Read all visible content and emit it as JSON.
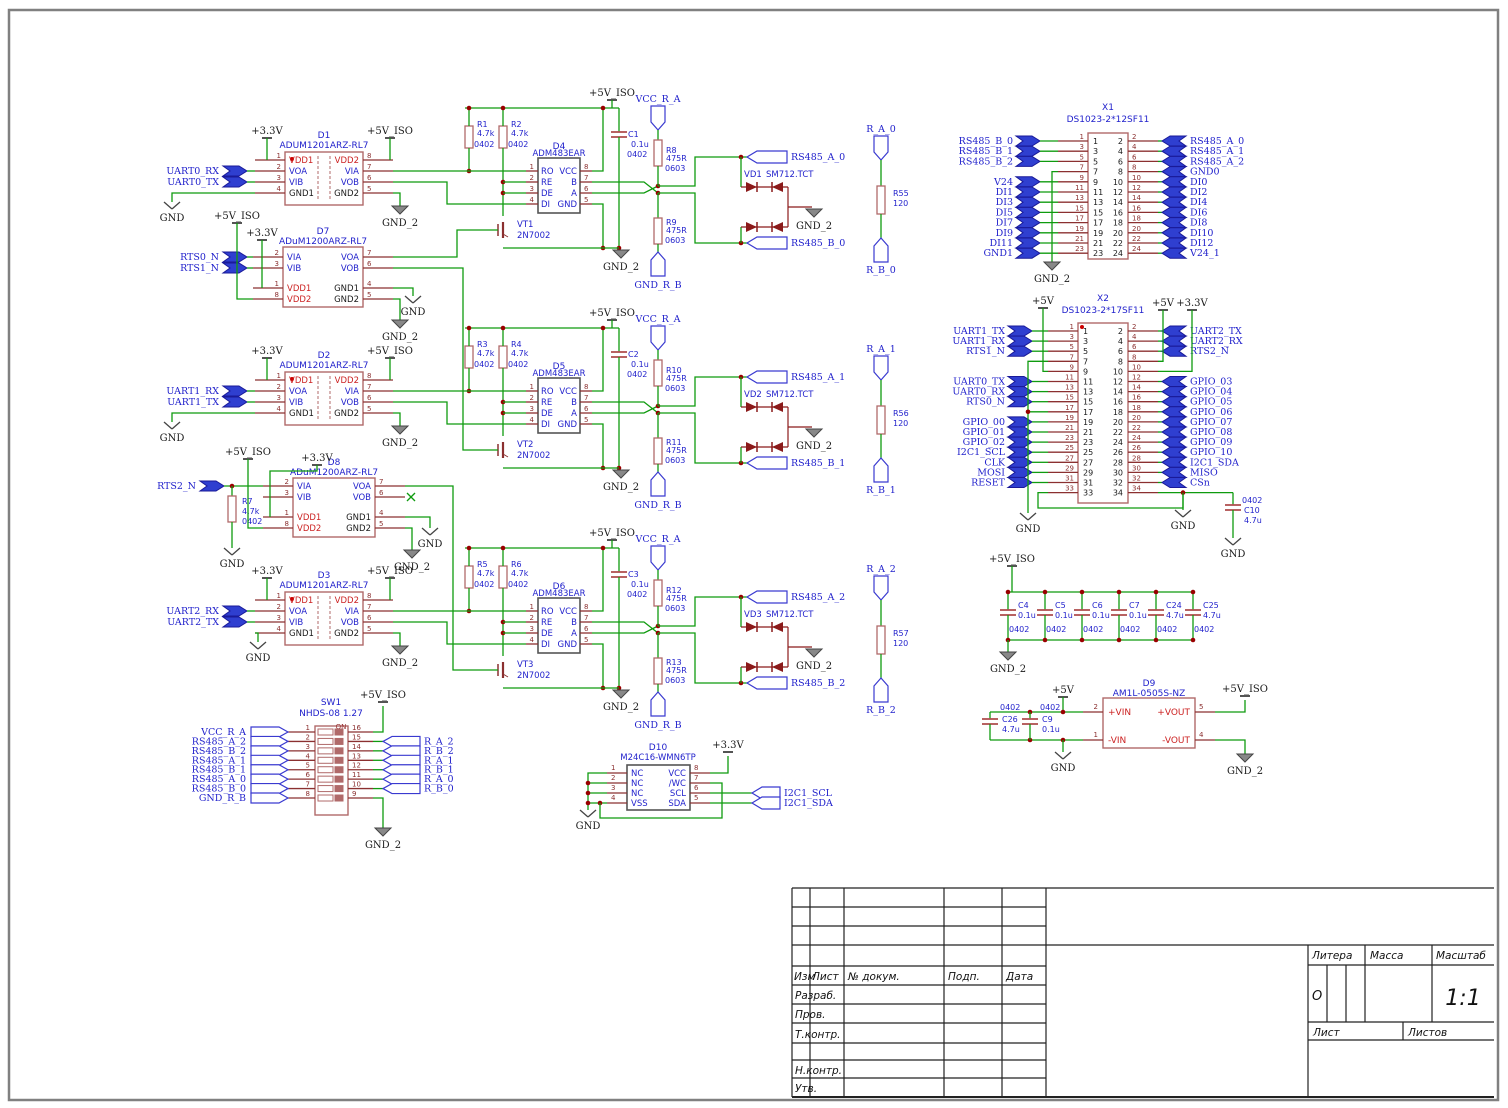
{
  "colors": {
    "wire": "#0f9b0f",
    "pin": "#8b3030",
    "body": "#b06a6a",
    "body2": "#555555",
    "blue": "#2222cc",
    "red": "#cc2222",
    "black": "#1a1a1a",
    "junction": "#990000",
    "flag_fill": "#2f3fd0",
    "tvs": "#8b1a1a",
    "frame": "#808080"
  },
  "power": {
    "p33": "+3.3V",
    "p5": "+5V",
    "p5iso": "+5V_ISO",
    "gnd": "GND",
    "gnd2": "GND_2"
  },
  "lib": {
    "iso_nums_l": [
      "1",
      "2",
      "3",
      "4"
    ],
    "iso_nums_r": [
      "8",
      "7",
      "6",
      "5"
    ],
    "iso_left": [
      "VDD1",
      "VOA",
      "VIB",
      "GND1"
    ],
    "iso_right": [
      "VDD2",
      "VIA",
      "VOB",
      "GND2"
    ],
    "rts_nums_l": [
      "2",
      "3",
      "1",
      "8"
    ],
    "rts_nums_r": [
      "7",
      "6",
      "4",
      "5"
    ],
    "rts_left": [
      "VIA",
      "VIB",
      "VDD1",
      "VDD2"
    ],
    "rts_right": [
      "VOA",
      "VOB",
      "GND1",
      "GND2"
    ],
    "xcvr_nums_l": [
      "1",
      "2",
      "3",
      "4"
    ],
    "xcvr_nums_r": [
      "8",
      "7",
      "6",
      "5"
    ],
    "xcvr_left": [
      "RO",
      "RE",
      "DE",
      "DI"
    ],
    "xcvr_right": [
      "VCC",
      "B",
      "A",
      "GND"
    ]
  },
  "channels": [
    {
      "iso_ref": "D1",
      "iso_part": "ADUM1201ARZ-RL7",
      "xcvr_ref": "D4",
      "xcvr_part": "ADM483EAR",
      "vt_ref": "VT1",
      "vt_part": "2N7002",
      "inputs": [
        "UART0_RX",
        "UART0_TX"
      ],
      "pull": [
        {
          "ref": "R1",
          "val": "4.7k",
          "fp": "0402"
        },
        {
          "ref": "R2",
          "val": "4.7k",
          "fp": "0402"
        }
      ],
      "cap": {
        "ref": "C1",
        "val": "0.1u",
        "fp": "0402"
      },
      "bias": [
        {
          "ref": "R8",
          "val": "475R",
          "fp": "0603"
        },
        {
          "ref": "R9",
          "val": "475R",
          "fp": "0603"
        }
      ],
      "tvs_ref": "VD1",
      "tvs_part": "SM712.TCT",
      "out_a": "RS485_A_0",
      "out_b": "RS485_B_0",
      "vcc": "VCC_R_A",
      "gnd_rb": "GND_R_B",
      "term": {
        "ref": "R55",
        "val": "120",
        "top": "R_A_0",
        "bot": "R_B_0"
      }
    },
    {
      "iso_ref": "D2",
      "iso_part": "ADUM1201ARZ-RL7",
      "xcvr_ref": "D5",
      "xcvr_part": "ADM483EAR",
      "vt_ref": "VT2",
      "vt_part": "2N7002",
      "inputs": [
        "UART1_RX",
        "UART1_TX"
      ],
      "pull": [
        {
          "ref": "R3",
          "val": "4.7k",
          "fp": "0402"
        },
        {
          "ref": "R4",
          "val": "4.7k",
          "fp": "0402"
        }
      ],
      "cap": {
        "ref": "C2",
        "val": "0.1u",
        "fp": "0402"
      },
      "bias": [
        {
          "ref": "R10",
          "val": "475R",
          "fp": "0603"
        },
        {
          "ref": "R11",
          "val": "475R",
          "fp": "0603"
        }
      ],
      "tvs_ref": "VD2",
      "tvs_part": "SM712.TCT",
      "out_a": "RS485_A_1",
      "out_b": "RS485_B_1",
      "vcc": "VCC_R_A",
      "gnd_rb": "GND_R_B",
      "term": {
        "ref": "R56",
        "val": "120",
        "top": "R_A_1",
        "bot": "R_B_1"
      }
    },
    {
      "iso_ref": "D3",
      "iso_part": "ADUM1201ARZ-RL7",
      "xcvr_ref": "D6",
      "xcvr_part": "ADM483EAR",
      "vt_ref": "VT3",
      "vt_part": "2N7002",
      "inputs": [
        "UART2_RX",
        "UART2_TX"
      ],
      "pull": [
        {
          "ref": "R5",
          "val": "4.7k",
          "fp": "0402"
        },
        {
          "ref": "R6",
          "val": "4.7k",
          "fp": "0402"
        }
      ],
      "cap": {
        "ref": "C3",
        "val": "0.1u",
        "fp": "0402"
      },
      "bias": [
        {
          "ref": "R12",
          "val": "475R",
          "fp": "0603"
        },
        {
          "ref": "R13",
          "val": "475R",
          "fp": "0603"
        }
      ],
      "tvs_ref": "VD3",
      "tvs_part": "SM712.TCT",
      "out_a": "RS485_A_2",
      "out_b": "RS485_B_2",
      "vcc": "VCC_R_A",
      "gnd_rb": "GND_R_B",
      "term": {
        "ref": "R57",
        "val": "120",
        "top": "R_A_2",
        "bot": "R_B_2"
      }
    }
  ],
  "rts": [
    {
      "ref": "D7",
      "part": "ADuM1200ARZ-RL7",
      "inputs": [
        "RTS0_N",
        "RTS1_N"
      ]
    },
    {
      "ref": "D8",
      "part": "ADuM1200ARZ-RL7",
      "inputs": [
        "RTS2_N"
      ],
      "r": {
        "ref": "R7",
        "val": "4.7k",
        "fp": "0402"
      }
    }
  ],
  "x1": {
    "ref": "X1",
    "part": "DS1023-2*12SF11",
    "left_nums": [
      "1",
      "3",
      "5",
      "7",
      "9",
      "11",
      "13",
      "15",
      "17",
      "19",
      "21",
      "23"
    ],
    "right_nums": [
      "2",
      "4",
      "6",
      "8",
      "10",
      "12",
      "14",
      "16",
      "18",
      "20",
      "22",
      "24"
    ],
    "left_labels": [
      "RS485_B_0",
      "RS485_B_1",
      "RS485_B_2",
      "",
      "V24",
      "DI1",
      "DI3",
      "DI5",
      "DI7",
      "DI9",
      "DI11",
      "GND1"
    ],
    "right_labels": [
      "RS485_A_0",
      "RS485_A_1",
      "RS485_A_2",
      "GND0",
      "DI0",
      "DI2",
      "DI4",
      "DI6",
      "DI8",
      "DI10",
      "DI12",
      "V24_1"
    ]
  },
  "x2": {
    "ref": "X2",
    "part": "DS1023-2*17SF11",
    "left_nums": [
      "1",
      "3",
      "5",
      "7",
      "9",
      "11",
      "13",
      "15",
      "17",
      "19",
      "21",
      "23",
      "25",
      "27",
      "29",
      "31",
      "33"
    ],
    "right_nums": [
      "2",
      "4",
      "6",
      "8",
      "10",
      "12",
      "14",
      "16",
      "18",
      "20",
      "22",
      "24",
      "26",
      "28",
      "30",
      "32",
      "34"
    ],
    "left_labels": [
      "UART1_TX",
      "UART1_RX",
      "RTS1_N",
      "",
      "",
      "UART0_TX",
      "UART0_RX",
      "RTS0_N",
      "",
      "GPIO_00",
      "GPIO_01",
      "GPIO_02",
      "I2C1_SCL",
      "CLK",
      "MOSI",
      "RESET",
      ""
    ],
    "right_labels": [
      "UART2_TX",
      "UART2_RX",
      "RTS2_N",
      "",
      "",
      "GPIO_03",
      "GPIO_04",
      "GPIO_05",
      "GPIO_06",
      "GPIO_07",
      "GPIO_08",
      "GPIO_09",
      "GPIO_10",
      "I2C1_SDA",
      "MISO",
      "CSn",
      ""
    ]
  },
  "c10": {
    "ref": "C10",
    "val": "4.7u",
    "fp": "0402"
  },
  "cap_bank": [
    {
      "ref": "C4",
      "val": "0.1u",
      "fp": "0402"
    },
    {
      "ref": "C5",
      "val": "0.1u",
      "fp": "0402"
    },
    {
      "ref": "C6",
      "val": "0.1u",
      "fp": "0402"
    },
    {
      "ref": "C7",
      "val": "0.1u",
      "fp": "0402"
    },
    {
      "ref": "C24",
      "val": "4.7u",
      "fp": "0402"
    },
    {
      "ref": "C25",
      "val": "4.7u",
      "fp": "0402"
    }
  ],
  "dcdc": {
    "ref": "D9",
    "part": "AM1L-0505S-NZ",
    "pins_l": [
      "+VIN",
      "-VIN"
    ],
    "nums_l": [
      "2",
      "1"
    ],
    "pins_r": [
      "+VOUT",
      "-VOUT"
    ],
    "nums_r": [
      "5",
      "4"
    ],
    "caps": [
      {
        "ref": "C26",
        "val": "4.7u",
        "fp": "0402"
      },
      {
        "ref": "C9",
        "val": "0.1u",
        "fp": "0402"
      }
    ]
  },
  "eeprom": {
    "ref": "D10",
    "part": "M24C16-WMN6TP",
    "left": [
      "NC",
      "NC",
      "NC",
      "VSS"
    ],
    "nums_l": [
      "1",
      "2",
      "3",
      "4"
    ],
    "right": [
      "VCC",
      "/WC",
      "SCL",
      "SDA"
    ],
    "nums_r": [
      "8",
      "7",
      "6",
      "5"
    ],
    "flags": [
      "I2C1_SCL",
      "I2C1_SDA"
    ]
  },
  "sw": {
    "ref": "SW1",
    "part": "NHDS-08  1.27",
    "on": "ON",
    "left_labels": [
      "VCC_R_A",
      "RS485_A_2",
      "RS485_B_2",
      "RS485_A_1",
      "RS485_B_1",
      "RS485_A_0",
      "RS485_B_0",
      "GND_R_B"
    ],
    "left_nums": [
      "1",
      "2",
      "3",
      "4",
      "5",
      "6",
      "7",
      "8"
    ],
    "right_nums": [
      "16",
      "15",
      "14",
      "13",
      "12",
      "11",
      "10",
      "9"
    ],
    "right_labels": [
      "",
      "R_A_2",
      "R_B_2",
      "R_A_1",
      "R_B_1",
      "R_A_0",
      "R_B_0",
      ""
    ]
  },
  "title_block": {
    "izm": "Изм",
    "list": "Лист",
    "ndok": "№ докум.",
    "podp": "Подп.",
    "data": "Дата",
    "razrab": "Разраб.",
    "prov": "Пров.",
    "tkontr": "Т.контр.",
    "nkontr": "Н.контр.",
    "utv": "Утв.",
    "litera": "Литера",
    "massa": "Масса",
    "masshtab": "Масштаб",
    "o": "О",
    "scale": "1:1",
    "list2": "Лист",
    "listov": "Листов"
  }
}
